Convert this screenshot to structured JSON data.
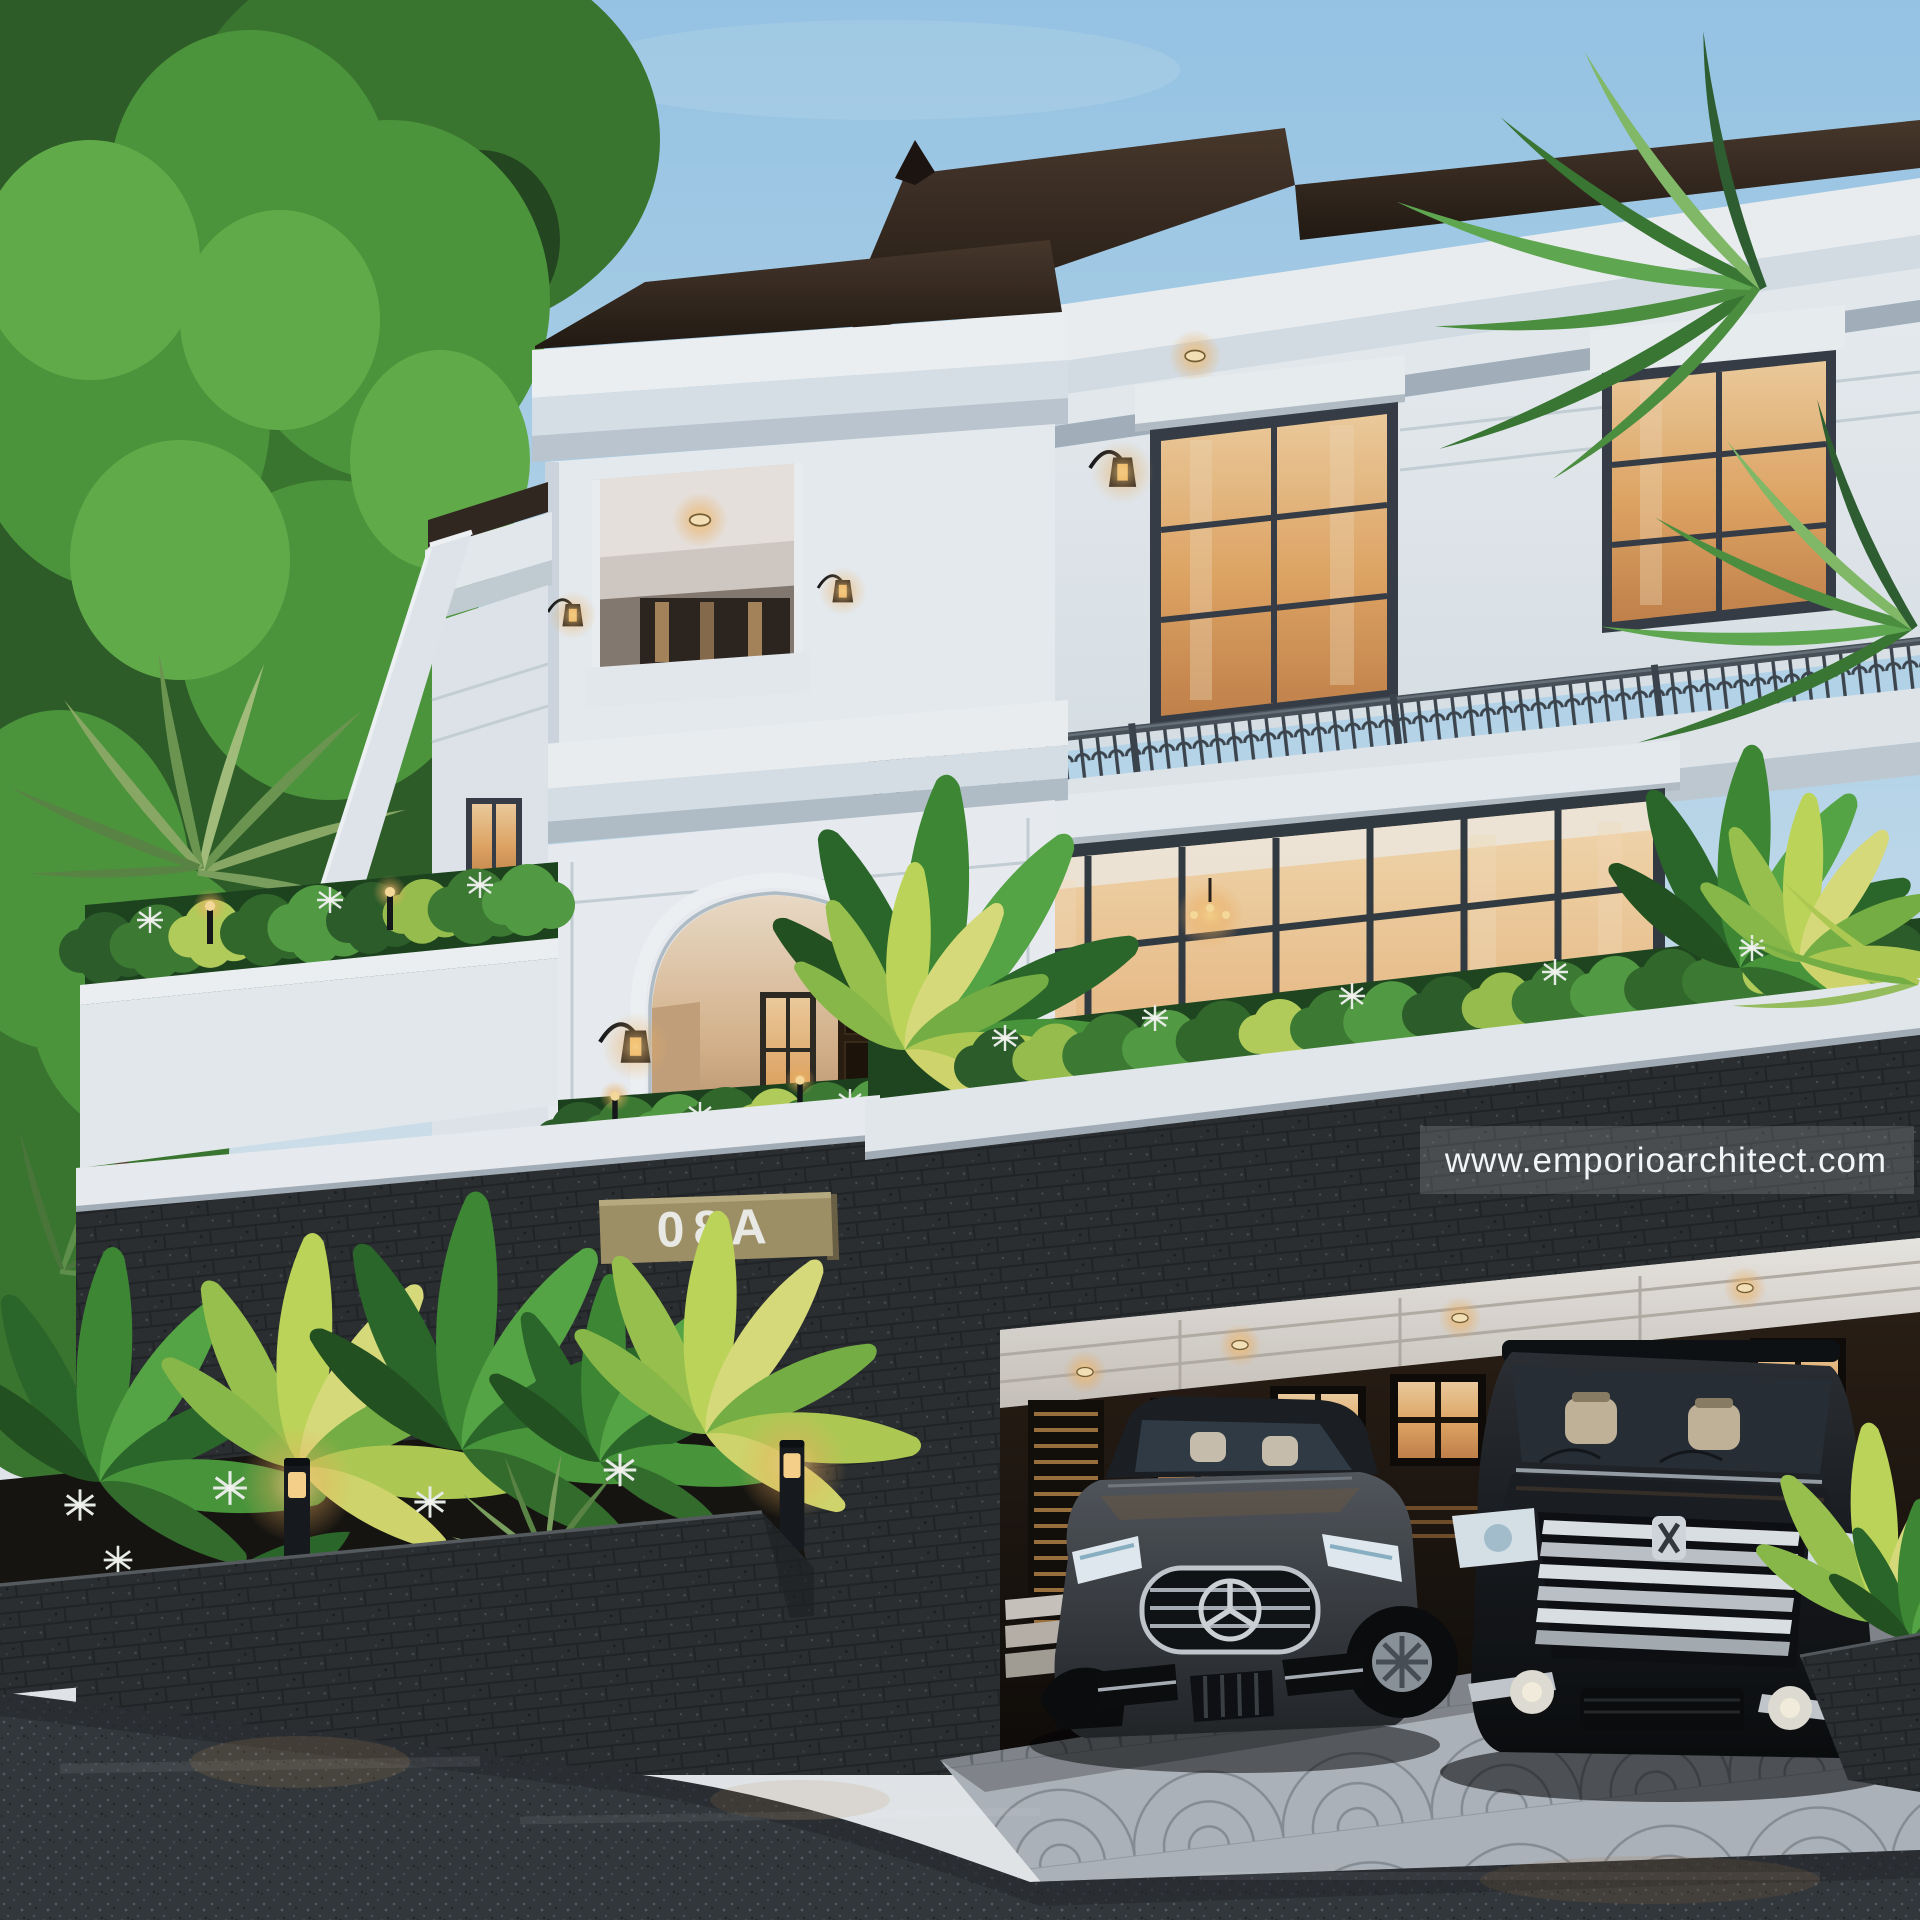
{
  "meta": {
    "type": "architectural-exterior-render",
    "description": "Three-storey classic modern villa at dusk with stone fence, carport, two cars and tropical landscaping"
  },
  "watermark": {
    "text": "www.emporioarchitect.com"
  },
  "house_number": {
    "text": "08A"
  },
  "palette": {
    "sky_top": "#9ecdec",
    "sky_horizon": "#e8eef2",
    "wall_white": "#eef2f5",
    "cornice_shadow": "#b3bec7",
    "roof_dark": "#2b2019",
    "stone_dark": "#2c2f30",
    "window_warm": "#f3c891",
    "plate_khaki": "#a59568",
    "foliage_green": "#3f7e33",
    "foliage_lit": "#c6dd5c",
    "asphalt": "#34383c",
    "paver_gray": "#b3b9bf"
  },
  "scene_objects": [
    "sky",
    "background-trees",
    "villa-facade",
    "roof",
    "third-floor-balcony",
    "balcony-railing",
    "entry-arch",
    "entry-door",
    "window-wall",
    "house-number-plate",
    "stone-fence",
    "carport",
    "garage-doors",
    "mercedes-sedan",
    "alphard-van",
    "front-planter",
    "bollard-light",
    "palm-fronds",
    "paver-apron",
    "street",
    "watermark"
  ]
}
